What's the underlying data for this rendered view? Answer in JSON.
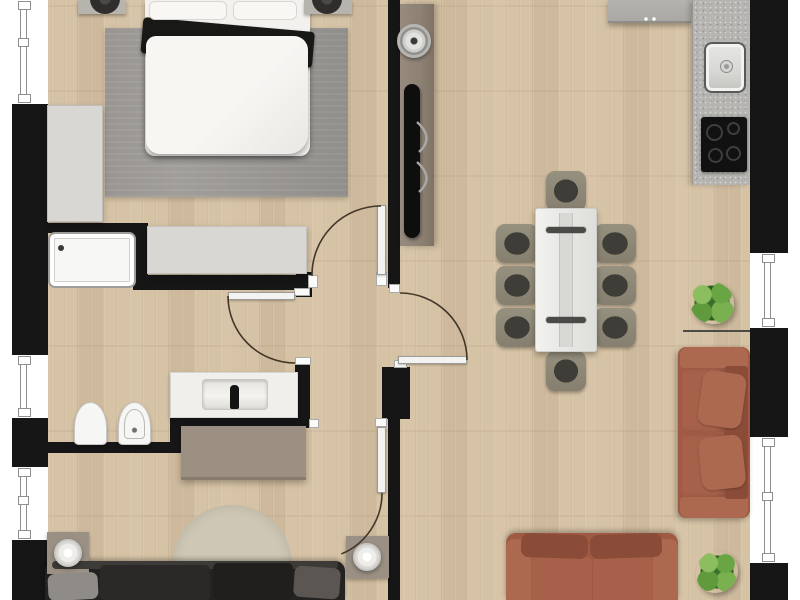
{
  "meta": {
    "type": "apartment-floor-plan",
    "view": "top-down-3d-render",
    "visible_text": "none"
  },
  "palette": {
    "page-bg": "#ffffff",
    "wall": "#161616",
    "floor-wood": "#d6c2a4",
    "window-white": "#ffffff",
    "window-frame": "#8f8f8f",
    "door-leaf": "#f3f3f1",
    "door-frame": "#9a9a97",
    "door-arc": "#44372a",
    "bedroom-rug": "#a19e9a",
    "bed-linen": "#f2f1ee",
    "blanket-black": "#181817",
    "nightstand-gray": "#b7b4ae",
    "lamp-dark": "#2f2e2c",
    "cabinet-light": "#d8d7d3",
    "shower-white": "#f7f7f5",
    "fixture-white": "#f6f6f4",
    "marble": "#f0efec",
    "faucet-black": "#141414",
    "sideboard-taupe": "#9c9082",
    "tv-panel-taupe": "#8d8174",
    "tv-black": "#0e0e0e",
    "clock-steel": "#b5b5b2",
    "kitchen-cabinet": "#a9a8a4",
    "kitchen-counter": "#b5b4b0",
    "sink-steel": "#d7d7d4",
    "cooktop-black": "#111111",
    "table-white": "#e9e9e6",
    "runner-gray": "#d8d8d5",
    "chair-frame": "#8e887b",
    "chair-seat": "#3e3d38",
    "sofa-terracotta": "#a05a44",
    "sofa-terracotta-light": "#ad6850",
    "sofa-terracotta-dark": "#8a4c38",
    "sofa-dark": "#242321",
    "sofa-dark-cushion": "#8f8c87",
    "side-table-taupe": "#9a9083",
    "lamp-white": "#eeede9",
    "round-rug": "#cec7b5",
    "plant-green": "#5f9a3d",
    "plant-green-dark": "#39702b"
  },
  "structure": {
    "exterior_walls": [
      "left",
      "right"
    ],
    "windows": [
      {
        "id": "left-top",
        "wall": "left"
      },
      {
        "id": "left-middle",
        "wall": "left"
      },
      {
        "id": "left-lower",
        "wall": "left"
      },
      {
        "id": "right-upper",
        "wall": "right"
      },
      {
        "id": "right-lower",
        "wall": "right"
      }
    ],
    "doors": [
      {
        "id": "bedroom-door",
        "type": "hinged",
        "swing": "into-bedroom"
      },
      {
        "id": "bathroom-door",
        "type": "hinged",
        "swing": "into-bathroom"
      },
      {
        "id": "living-room-door",
        "type": "hinged",
        "swing": "into-living-room"
      },
      {
        "id": "lounge-door",
        "type": "hinged",
        "swing": "into-lounge"
      }
    ]
  },
  "rooms": [
    {
      "id": "bedroom",
      "position": "top-left",
      "furniture": [
        "double-bed",
        "pillows",
        "black-throw-blanket",
        "gray-area-rug",
        "nightstand-left",
        "nightstand-right",
        "bedside-lamp-left",
        "bedside-lamp-right",
        "wardrobe",
        "low-dresser"
      ]
    },
    {
      "id": "bathroom",
      "position": "middle-left",
      "fixtures": [
        "shower-tray-with-drain",
        "toilet",
        "bidet",
        "marble-vanity-counter",
        "rectangular-basin",
        "black-faucet"
      ]
    },
    {
      "id": "hallway",
      "position": "center",
      "furniture": [
        "taupe-sideboard"
      ]
    },
    {
      "id": "living-dining-kitchen",
      "position": "right",
      "furniture": [
        "tv-wall-panel",
        "wall-clock",
        "flatscreen-tv",
        "kitchen-top-cabinet",
        "kitchen-counter",
        "stainless-sink",
        "induction-cooktop-4-burners",
        "dining-table",
        "table-runner",
        "candle-holder-top",
        "candle-holder-bottom",
        "dining-chairs",
        "terracotta-sofa-right",
        "terracotta-sofa-bottom",
        "potted-plant-upper",
        "potted-plant-lower",
        "radiator-line"
      ]
    },
    {
      "id": "lounge",
      "position": "bottom-left",
      "furniture": [
        "dark-sectional-sofa",
        "round-beige-rug",
        "side-table-left",
        "side-table-right",
        "round-lamp-left",
        "round-lamp-right"
      ]
    }
  ],
  "counts": {
    "dining_chairs": 8,
    "windows": 5,
    "interior_doors": 4,
    "plants": 2,
    "sofas": 3,
    "table_lamps": 4
  }
}
